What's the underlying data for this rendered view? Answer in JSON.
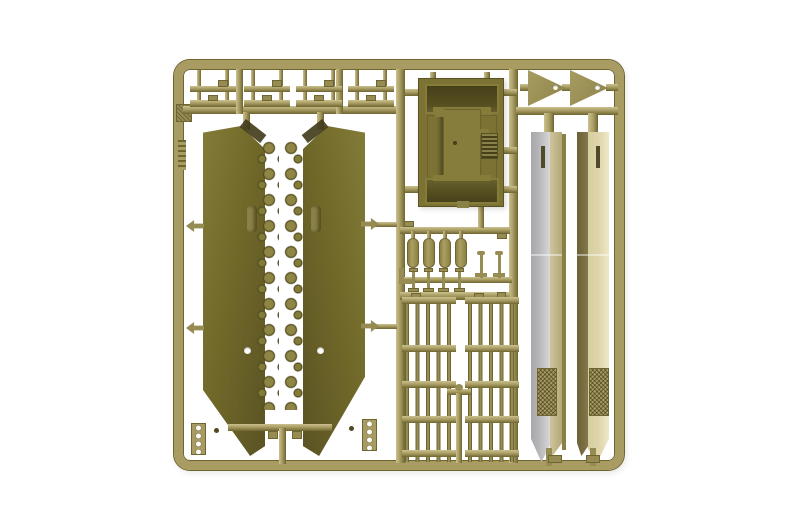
{
  "image": {
    "kind": "photograph",
    "subject": "injection-molded plastic model kit sprue (parts tree) in olive-khaki plastic on a white background",
    "legible_text": ""
  },
  "colors": {
    "background": "#ffffff",
    "runner": "#a89c62",
    "runner-light": "#cbc18f",
    "runner-dark": "#6e6530",
    "tab": "#968b52",
    "panel": "#716929",
    "panel-light": "#837b38",
    "panel-edge": "#5a5324",
    "detail-dark": "#3f3a18",
    "knob": "#8f8545",
    "knob-dark": "#4f4a1d",
    "box": "#7b7233",
    "box-raised": "#867d3c",
    "box-dark": "#453f1a",
    "grille-bar": "#978c54",
    "blade-gray": "#b5b4b6",
    "blade-khaki": "#cfc49c",
    "blade-olive": "#6b6136",
    "blade-cream": "#ded5ab",
    "texture": "#a89c62"
  },
  "parts": {
    "frame": {
      "name": "sprue frame with rounded corners",
      "count": 1
    },
    "bracket_groups": {
      "name": "small bracket/step parts",
      "groups": 4,
      "bars_per_group": 2
    },
    "hull_panels": {
      "name": "large tapered side panels with knob detail rows",
      "count": 2
    },
    "box_body": {
      "name": "box-shaped body shell with grille detail",
      "count": 1
    },
    "triangles": {
      "name": "triangular wedge parts with hole",
      "count": 2
    },
    "cylinders": {
      "name": "capsule cylinder parts",
      "count": 4
    },
    "spools": {
      "name": "small spool parts on runner",
      "count": 4
    },
    "pins": {
      "name": "pin parts with flat heads",
      "count": 2
    },
    "grilles": {
      "name": "slatted grille panels",
      "count": 2
    },
    "blades": {
      "name": "long two-tone blade panels with textured pad",
      "count": 2
    },
    "ladder_clips": {
      "name": "small ladder clip parts",
      "count": 2
    },
    "molded_tag": {
      "name": "molded square tag and embossed marking on left rail",
      "count": 1
    }
  }
}
